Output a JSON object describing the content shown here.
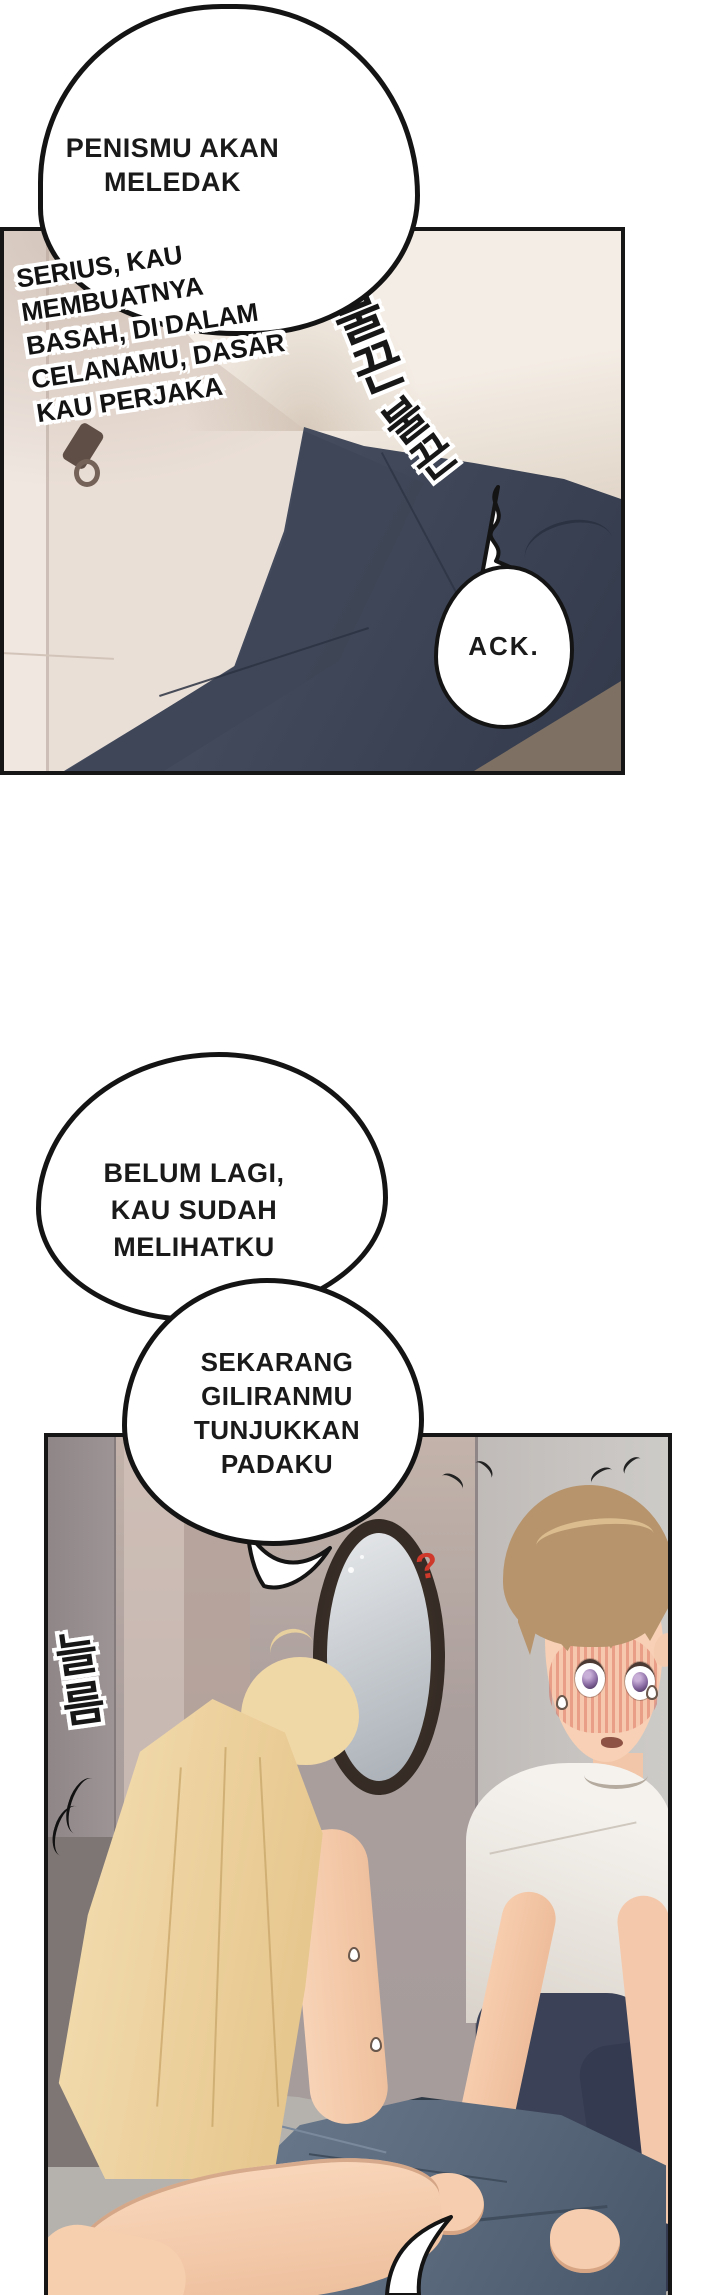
{
  "page": {
    "type": "comic-page",
    "language": "Indonesian",
    "bg_color": "#ffffff"
  },
  "panel1": {
    "speech_bubble": {
      "lines": [
        "PENISMU AKAN",
        "MELEDAK"
      ]
    },
    "caption": {
      "lines": [
        "SERIUS, KAU",
        "MEMBUATNYA",
        "BASAH, DI DALAM",
        "CELANAMU, DASAR",
        "KAU PERJAKA"
      ]
    },
    "small_bubble": {
      "text": "ACK."
    },
    "sfx": [
      {
        "text": "불끈"
      },
      {
        "text": "불끈"
      }
    ]
  },
  "bubble2": {
    "lines": [
      "BELUM LAGI,",
      "KAU SUDAH",
      "MELIHATKU"
    ]
  },
  "bubble3": {
    "lines": [
      "SEKARANG",
      "GILIRANMU",
      "TUNJUKKAN",
      "PADAKU"
    ]
  },
  "panel2": {
    "sfx": [
      {
        "text": "늘름"
      }
    ],
    "question_marks": {
      "left": "?",
      "right": "?"
    }
  },
  "colors": {
    "ink": "#141414",
    "panel1_wall": "#eadfd7",
    "jeans_dark": "#3e4657",
    "held_jeans": "#5d6c7f",
    "panel2_wall": "#ab9f9d",
    "hair_blonde": "#eed5a4",
    "hair_brown": "#b7946c",
    "skin": "#f6cfb0",
    "question_red": "#ce392b",
    "mirror_frame": "#362c25"
  }
}
